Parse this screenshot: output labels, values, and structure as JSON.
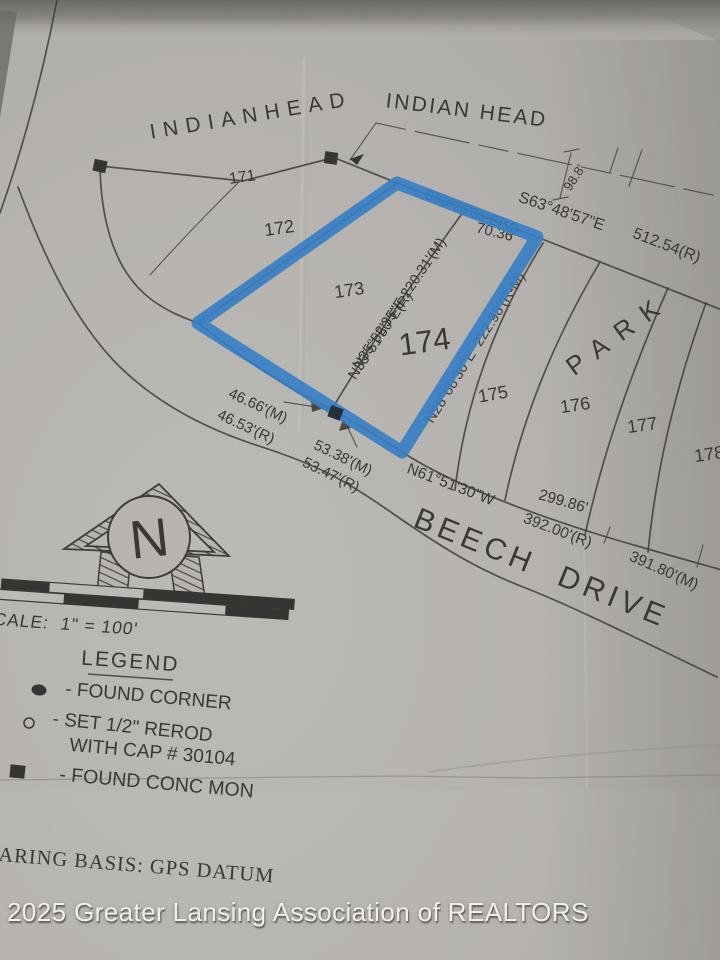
{
  "plat": {
    "subdivisions": {
      "indianhead": "INDIANHEAD",
      "indian_head": "INDIAN HEAD"
    },
    "streets": {
      "beech_drive": "BEECH  DRIVE",
      "park": "PARK"
    },
    "lot_numbers": {
      "l171": "171",
      "l172": "172",
      "l173": "173",
      "l174": "174",
      "l175": "175",
      "l176": "176",
      "l177": "177",
      "l178": "178"
    },
    "dimensions": {
      "d98": "98.8'",
      "s63_48": "S63°48'57\"E",
      "d512": "512.54(R)",
      "s63_26": "S63°26'36\"E(M)",
      "d70": "70.36'",
      "n35_m": "N35°52'35\"E 220.31'(M)",
      "n35_r": "N35°51'50\"E(R)",
      "n28": "N28°08'30\"E  222.98'(R-M)",
      "d4666": "46.66'(M)",
      "d4653": "46.53'(R)",
      "d5338": "53.38'(M)",
      "d5347": "53.47'(R)",
      "n61": "N61°51'30\"W",
      "d299": "299.86'",
      "d392": "392.00'(R)",
      "d391": "391.80'(M)"
    },
    "highlight_color": "#2a82d8"
  },
  "north_arrow": {
    "label": "N"
  },
  "scale_bar": {
    "label": "SCALE:  1\" = 100'"
  },
  "legend": {
    "title": "LEGEND",
    "found_corner": "- FOUND CORNER",
    "set_rerod_line1": "- SET 1/2\" REROD",
    "set_rerod_line2": "WITH CAP # 30104",
    "conc_mon": "- FOUND CONC MON"
  },
  "notes": {
    "bearing_basis": "ARING BASIS: GPS DATUM"
  },
  "photo": {
    "watermark": "2025 Greater Lansing Association of REALTORS"
  }
}
